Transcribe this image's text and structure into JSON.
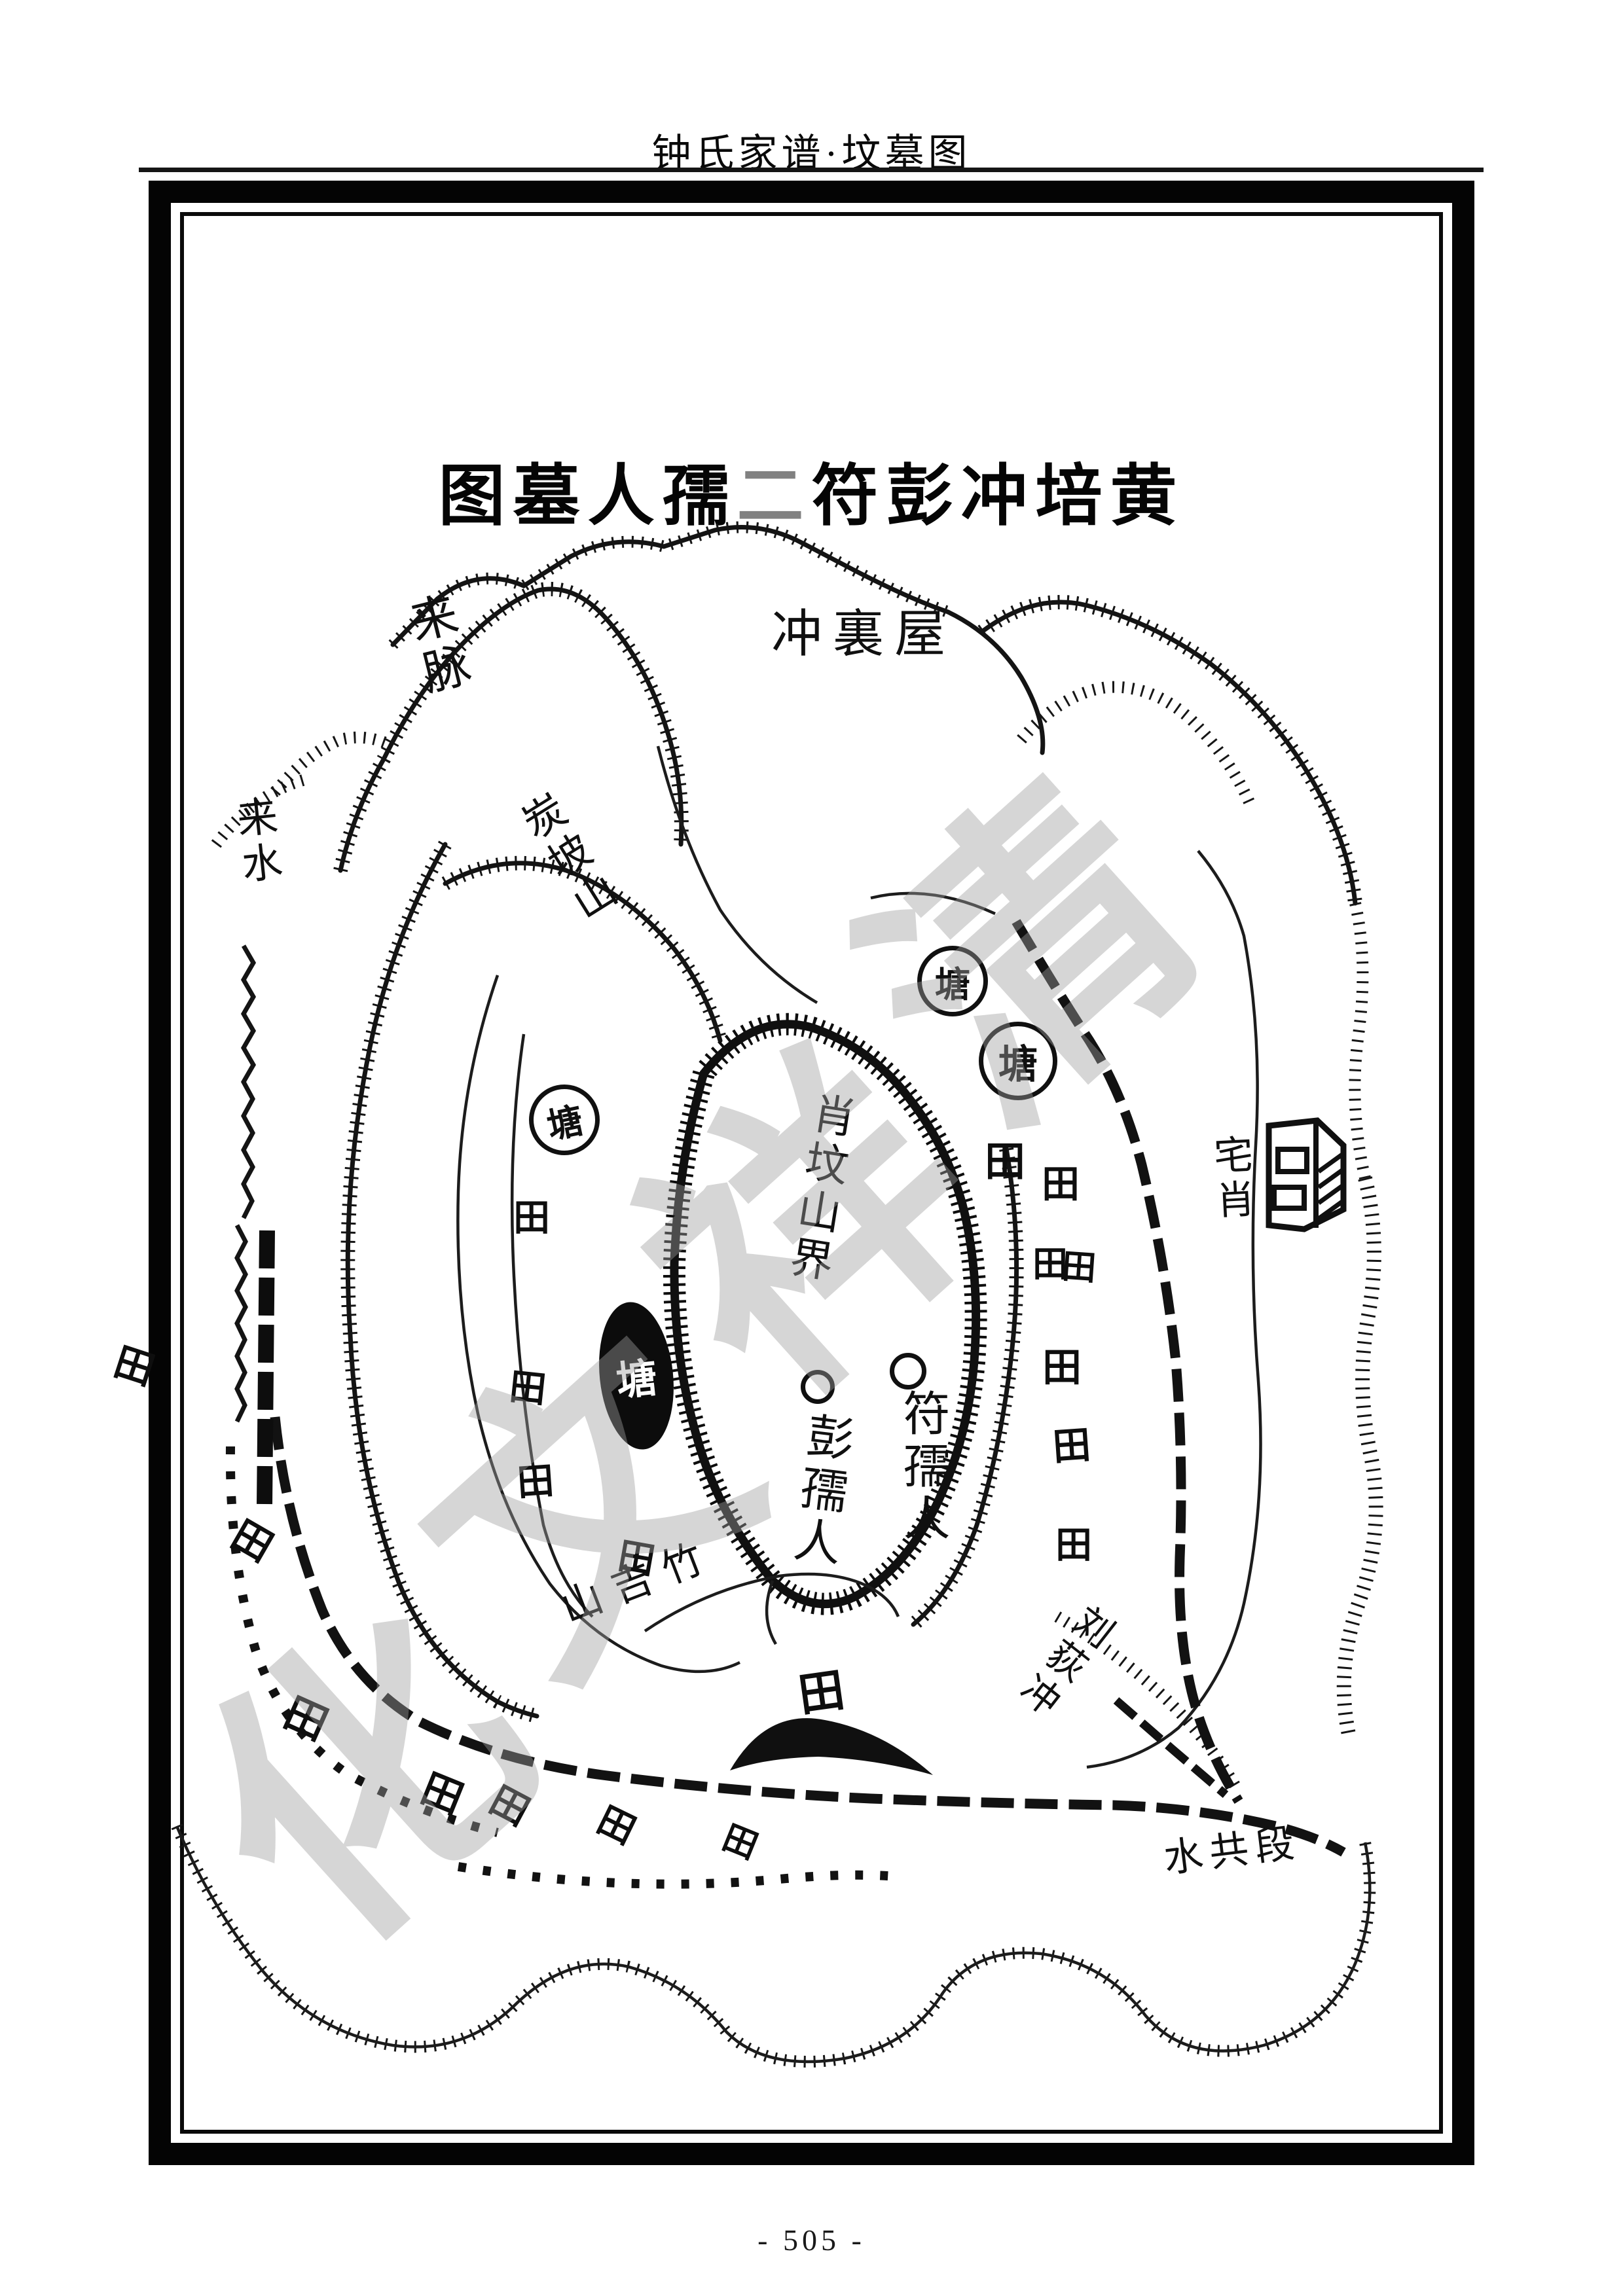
{
  "page": {
    "header_title": "钟氏家谱·坟墓图",
    "page_number": "- 505 -"
  },
  "map": {
    "title_parts": [
      "图墓人孺",
      "二",
      "符彭冲培黄"
    ],
    "watermark_text": "清祥文化",
    "ink_color": "#111111",
    "watermark_color": "#9f9f9f",
    "labels": {
      "chong_li_wu": "冲裏屋",
      "lai_mai": "来脉",
      "lai_shui": "来水",
      "tan_po_shan": "炭坡山",
      "xiao_fen_shan_jie": "肖坟山界",
      "fu_ru_ren": "符孺人",
      "peng_ru_ren": "彭孺人",
      "zhai_xiao": "宅肖",
      "ji_shan": "山吉竹",
      "liu_di_chong": "刘荻冲",
      "shui_gong_duan": "水共段",
      "pond": "塘",
      "field": "田"
    }
  }
}
